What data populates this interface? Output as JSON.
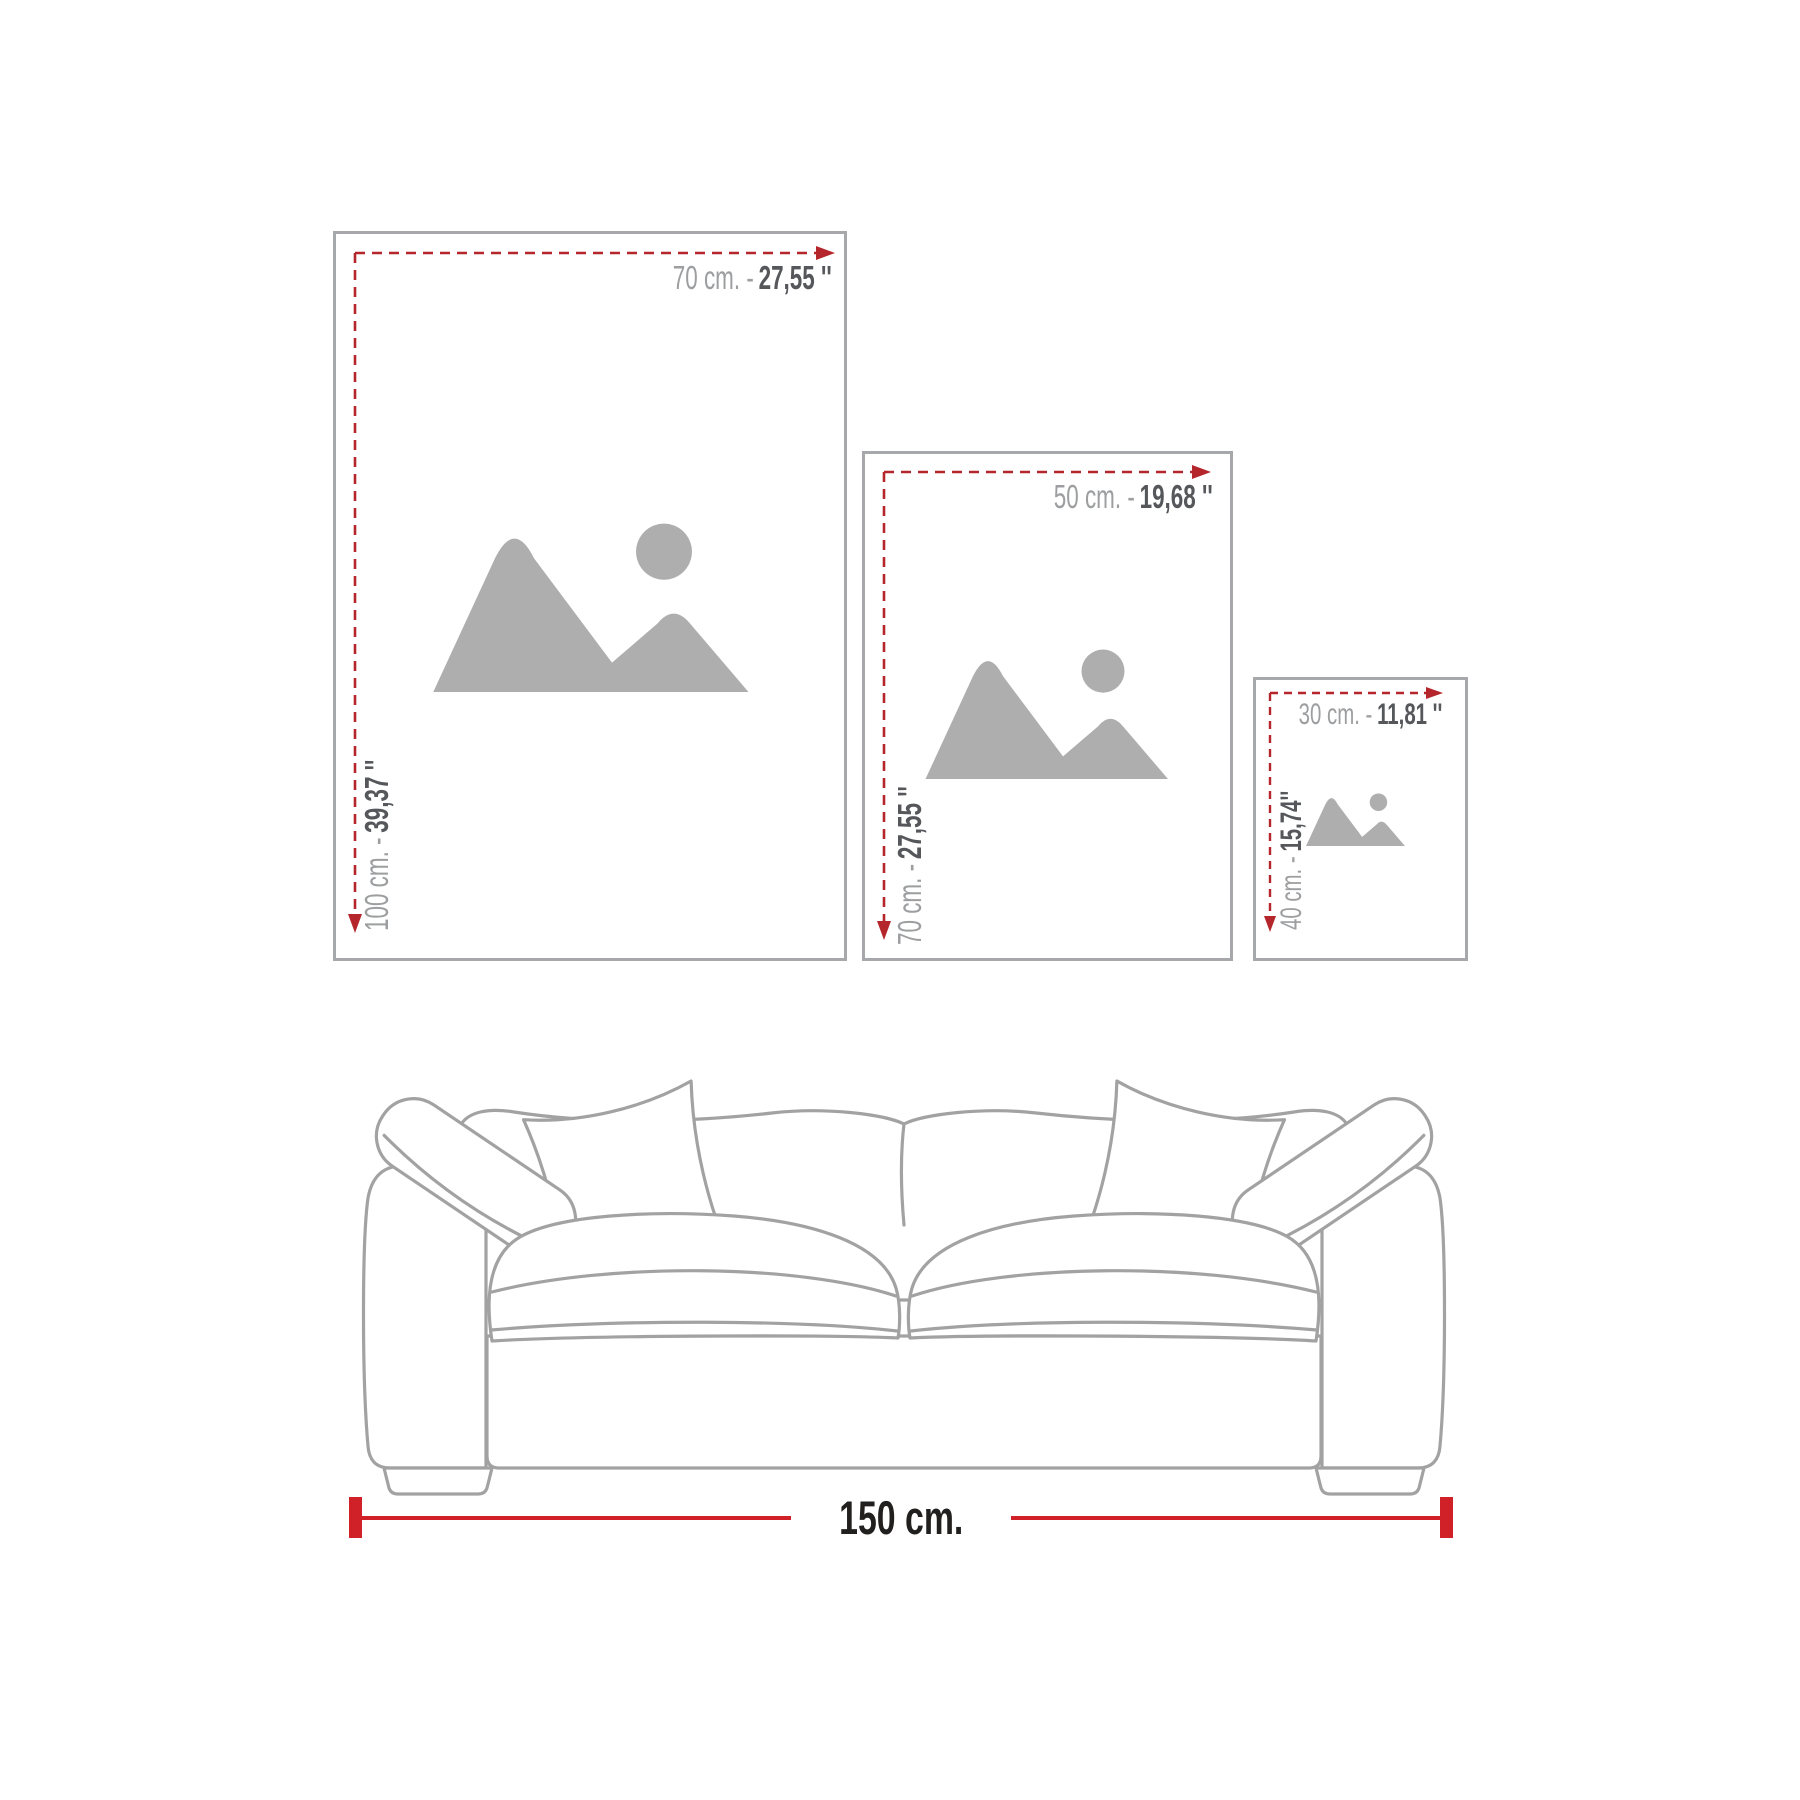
{
  "frames": [
    {
      "name": "large",
      "width_cm": "70 cm. -",
      "width_in": "27,55 ''",
      "height_cm": "100 cm. -",
      "height_in": "39,37 ''"
    },
    {
      "name": "medium",
      "width_cm": "50 cm. -",
      "width_in": "19,68 ''",
      "height_cm": "70 cm. -",
      "height_in": "27,55 ''"
    },
    {
      "name": "small",
      "width_cm": "30 cm. -",
      "width_in": "11,81 ''",
      "height_cm": "40 cm. -",
      "height_in": "15,74''"
    }
  ],
  "sofa": {
    "width_label": "150 cm."
  },
  "icons": {
    "placeholder": "image-placeholder-icon"
  },
  "colors": {
    "dash_red": "#b5262c",
    "bar_red": "#d02128",
    "label_gray": "#9c9ea0",
    "label_dark": "#55575b",
    "frame_border": "#a6a8ab",
    "sofa_outline": "#a2a2a2",
    "icon_gray": "#aeaeae",
    "text_black": "#221f1f"
  }
}
